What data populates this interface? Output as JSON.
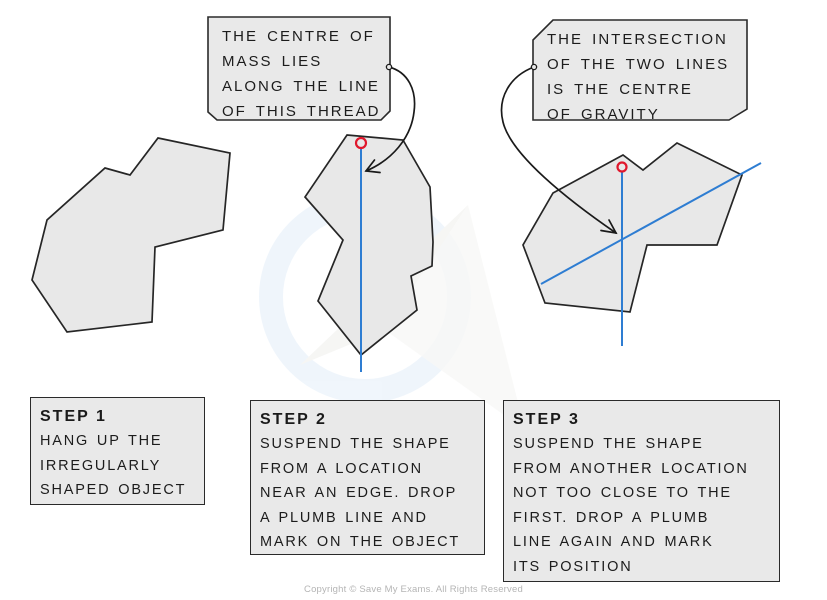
{
  "page": {
    "copyright": "Copyright © Save My Exams. All Rights Reserved"
  },
  "colors": {
    "shape_fill": "#e8e8e8",
    "box_fill": "#e9e9e9",
    "outline": "#262626",
    "plumb_line_blue": "#2e7dd2",
    "pin_red": "#e0182d",
    "watermark_blue": "#e6f0fa",
    "copyright_gray": "#b5b5b5"
  },
  "callouts": [
    {
      "id": "centre-of-mass-note",
      "lines": [
        "THE CENTRE OF",
        "MASS LIES",
        "ALONG THE LINE",
        "OF THIS THREAD"
      ]
    },
    {
      "id": "intersection-note",
      "lines": [
        "THE INTERSECTION",
        "OF THE TWO LINES",
        "IS THE CENTRE",
        "OF GRAVITY"
      ]
    }
  ],
  "steps": [
    {
      "title": "STEP 1",
      "lines": [
        "HANG UP THE",
        "IRREGULARLY",
        "SHAPED OBJECT"
      ]
    },
    {
      "title": "STEP 2",
      "lines": [
        "SUSPEND THE SHAPE",
        "FROM A LOCATION",
        "NEAR AN EDGE. DROP",
        "A PLUMB LINE AND",
        "MARK ON THE OBJECT"
      ]
    },
    {
      "title": "STEP 3",
      "lines": [
        "SUSPEND THE SHAPE",
        "FROM ANOTHER LOCATION",
        "NOT TOO CLOSE TO THE",
        "FIRST. DROP A PLUMB",
        "LINE AGAIN AND MARK",
        "ITS POSITION"
      ]
    }
  ],
  "figures": [
    {
      "name": "irregularly-shaped-object"
    },
    {
      "name": "shape-suspended-with-plumb-line",
      "pin": "suspension-point",
      "line": "plumb-line"
    },
    {
      "name": "shape-with-two-plumb-lines",
      "pin": "suspension-point",
      "lines": "two-plumb-lines-intersecting"
    }
  ]
}
